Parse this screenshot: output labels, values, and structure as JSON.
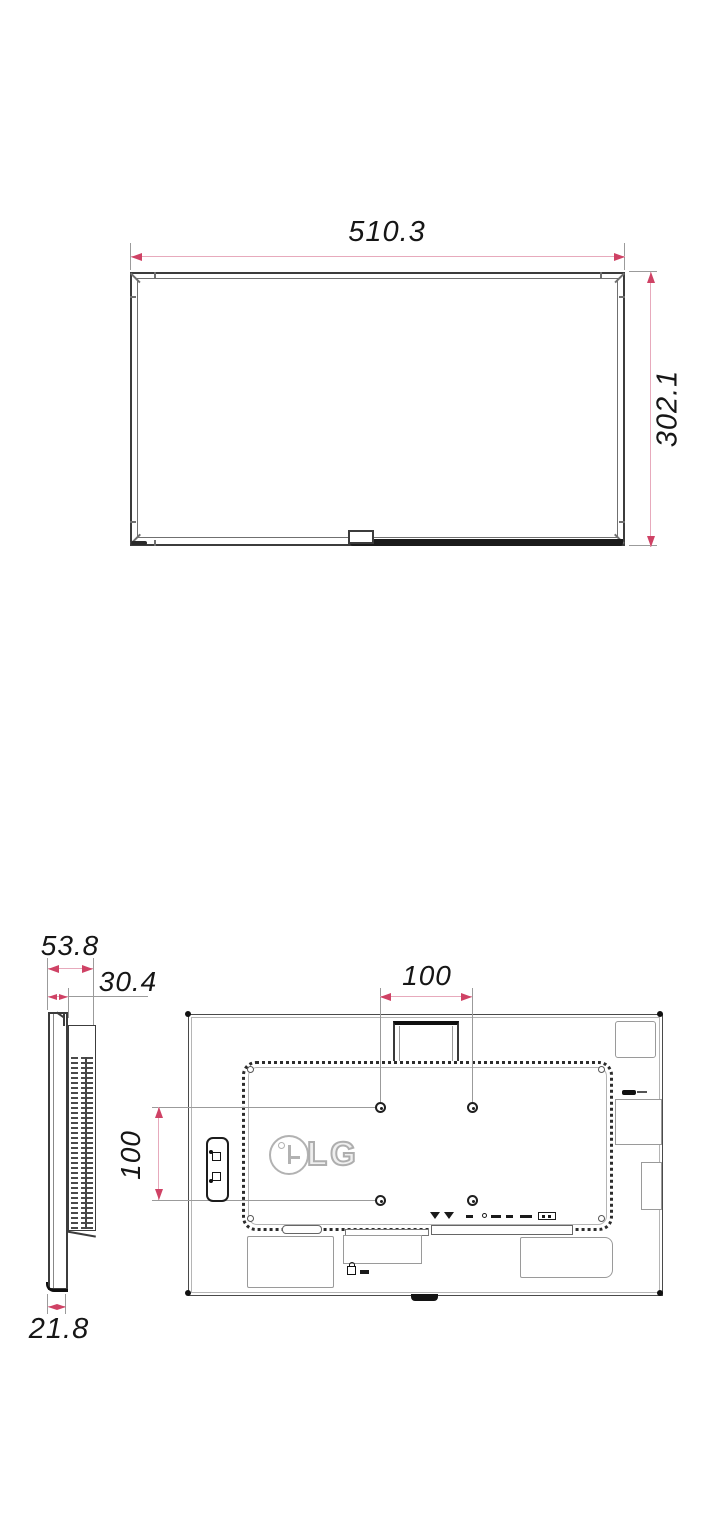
{
  "drawing": {
    "type": "monitor-dimension-diagram",
    "accent_color": "#cf4265",
    "dim_line_color": "#e7aabc",
    "extension_line_color": "#9b9b9b",
    "line_color": "#3c3c3c",
    "front_view": {
      "width": "510.3",
      "height": "302.1"
    },
    "side_view": {
      "total_depth": "53.8",
      "upper_depth": "30.4",
      "bottom_depth": "21.8"
    },
    "rear_view": {
      "vesa_width": "100",
      "vesa_height": "100",
      "logo": "LG"
    }
  }
}
